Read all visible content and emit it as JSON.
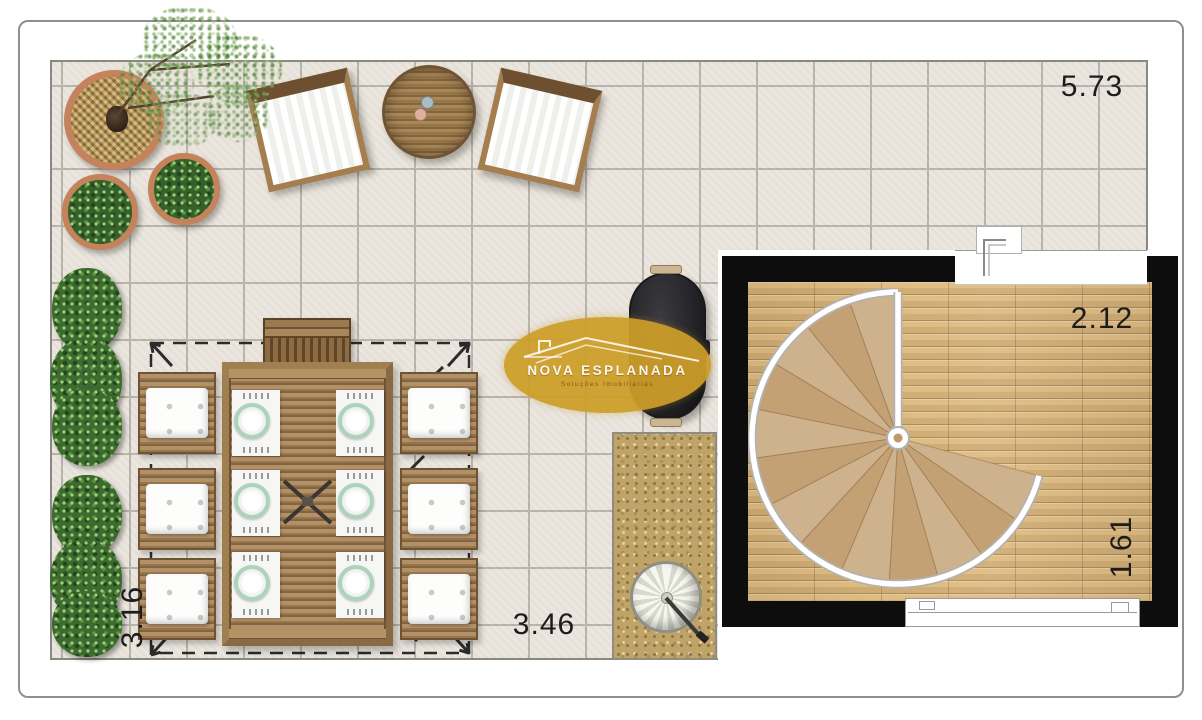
{
  "floorplan": {
    "dimensions": {
      "terrace_top_width": "5.73",
      "stair_room_width": "2.12",
      "stair_room_depth": "1.61",
      "terrace_bottom_width": "3.46",
      "terrace_left_depth": "3.16"
    },
    "watermark": {
      "title": "NOVA ESPLANADA",
      "subtitle": "Soluções Imobiliárias"
    },
    "colors": {
      "tile": "#eae5dd",
      "grout": "#b7b3ab",
      "wall": "#0d0d0d",
      "wood_floor": "#debb81",
      "wood_furniture": "#97764a",
      "hedge_green": "#3c6a30",
      "planter_rim": "#c4835b",
      "sand": "#c0a467",
      "gold_watermark": "#cd9d29",
      "plate_rim": "#aed2bc",
      "dimension_text": "#1c1c1c"
    }
  }
}
